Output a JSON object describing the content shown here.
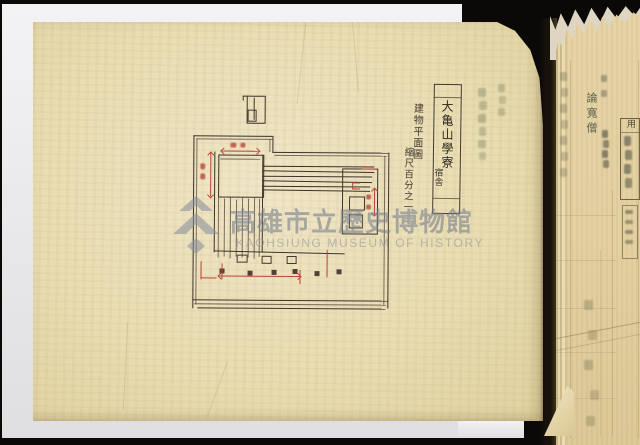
{
  "scan": {
    "background_color": "#0b0908",
    "backing_sheet_color": "#ebebee",
    "page_color": "#e9ddb2",
    "side_page_color": "#e4d1a2",
    "ink_color": "#3b332a",
    "dimension_color": "#b8453a",
    "watermark_color": "#8a909c"
  },
  "watermark": {
    "logo": "kaohsiung-museum-logo",
    "title_cjk": "高雄市立歷史博物館",
    "title_latin": "KAOHSIUNG MUSEUM OF HISTORY"
  },
  "plan": {
    "title_box_main": "大亀山學寮",
    "title_box_sub": "宿舎",
    "annotation_1": "建物平面圖",
    "annotation_2": "縮尺百分之一"
  },
  "side_page": {
    "printed_label": "論寬僧",
    "field_label": "用"
  }
}
